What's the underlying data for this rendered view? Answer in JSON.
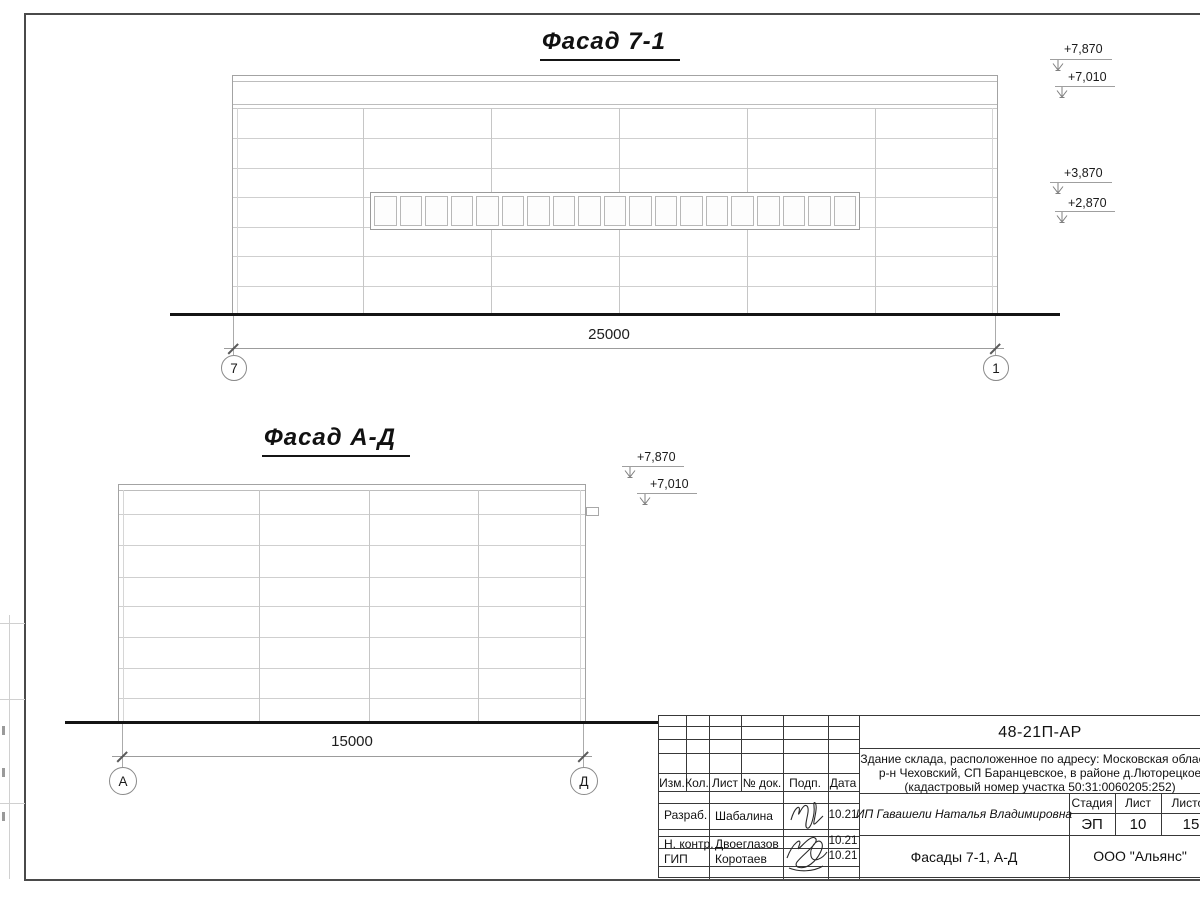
{
  "facade1": {
    "title": "Фасад 7-1",
    "dim": "25000",
    "axis_left": "7",
    "axis_right": "1",
    "elev": {
      "e1": "+7,870",
      "e2": "+7,010",
      "e3": "+3,870",
      "e4": "+2,870"
    }
  },
  "facade2": {
    "title": "Фасад А-Д",
    "dim": "15000",
    "axis_left": "А",
    "axis_right": "Д",
    "elev": {
      "e1": "+7,870",
      "e2": "+7,010"
    }
  },
  "titleblock": {
    "doc_code": "48-21П-АР",
    "desc1": "Здание склада, расположенное по адресу: Московская область,",
    "desc2": "р-н Чеховский, СП Баранцевское, в районе д.Люторецкое",
    "desc3": "(кадастровый номер участка 50:31:0060205:252)",
    "cols": {
      "izm": "Изм.",
      "kol": "Кол.",
      "list": "Лист",
      "doc": "№ док.",
      "podp": "Подп.",
      "data": "Дата"
    },
    "rows": {
      "r1": {
        "role": "Разраб.",
        "name": "Шабалина",
        "date": "10.21"
      },
      "r2": {
        "role": "Н. контр.",
        "name": "Двоеглазов",
        "date": "10.21"
      },
      "r3": {
        "role": "ГИП",
        "name": "Коротаев",
        "date": "10.21"
      }
    },
    "client": "ИП Гавашели Наталья Владимировна",
    "stage_label": "Стадия",
    "sheet_label": "Лист",
    "sheets_label": "Листов",
    "stage": "ЭП",
    "sheet_no": "10",
    "sheets_total": "15",
    "sheet_title": "Фасады 7-1, А-Д",
    "org": "ООО \"Альянс\""
  }
}
